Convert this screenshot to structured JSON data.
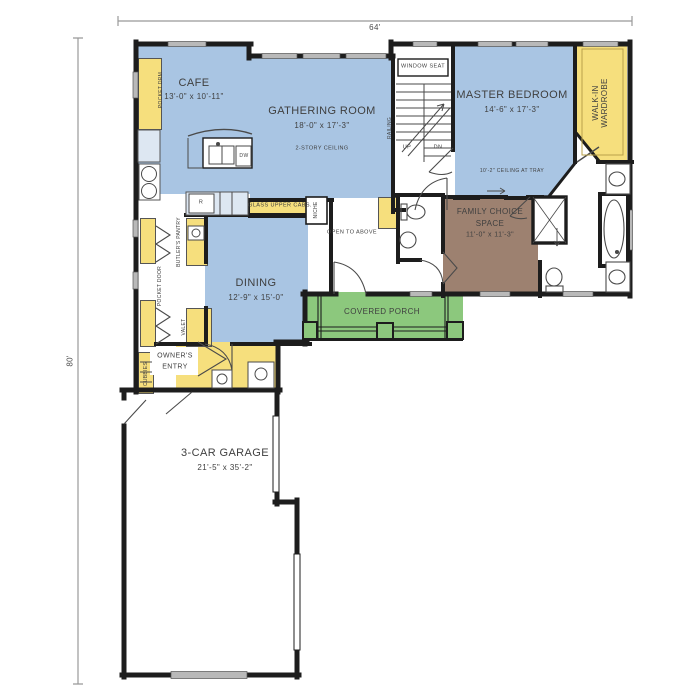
{
  "title": "First Floor Plan",
  "dimensions": {
    "width_label": "64'",
    "height_label": "80'"
  },
  "rooms": {
    "cafe": {
      "name": "CAFE",
      "size": "13'-0\" x 10'-11\""
    },
    "gathering": {
      "name": "GATHERING ROOM",
      "size": "18'-0\" x 17'-3\"",
      "note": "2-STORY CEILING"
    },
    "master": {
      "name": "MASTER BEDROOM",
      "size": "14'-6\" x 17'-3\"",
      "note": "10'-2\" CEILING AT TRAY"
    },
    "wardrobe": {
      "line1": "WALK-IN",
      "line2": "WARDROBE"
    },
    "family": {
      "line1": "FAMILY CHOICE",
      "line2": "SPACE",
      "size": "11'-0\" x 11'-3\""
    },
    "dining": {
      "name": "DINING",
      "size": "12'-9\" x 15'-0\""
    },
    "owners_entry": {
      "line1": "OWNER'S",
      "line2": "ENTRY"
    },
    "porch": {
      "name": "COVERED PORCH"
    },
    "garage": {
      "name": "3-CAR GARAGE",
      "size": "21'-5\" x 35'-2\""
    }
  },
  "annotations": {
    "window_seat": "WINDOW SEAT",
    "open_to_above": "OPEN TO ABOVE",
    "glass_upper_cabs": "GLASS UPPER CABS.",
    "niche": "NICHE",
    "butlers_pantry": "BUTLER'S PANTRY",
    "pocket_door": "POCKET DOOR",
    "pocket_drm": "POCKET DRM",
    "valet": "VALET",
    "cubbies": "CUBBIES",
    "railing": "RAILING",
    "up": "UP",
    "dn": "DN",
    "dw": "DW",
    "range": "R"
  },
  "colors": {
    "room_blue": "#a9c5e3",
    "room_yellow": "#f6df7d",
    "room_brown": "#9d8170",
    "porch_green": "#8cc87d",
    "wall": "#1d1d1d",
    "window_gray": "#b9b9b9",
    "counter_blue": "#dde7f2",
    "dimension_gray": "#999999",
    "text_gray": "#3f3f3f"
  }
}
